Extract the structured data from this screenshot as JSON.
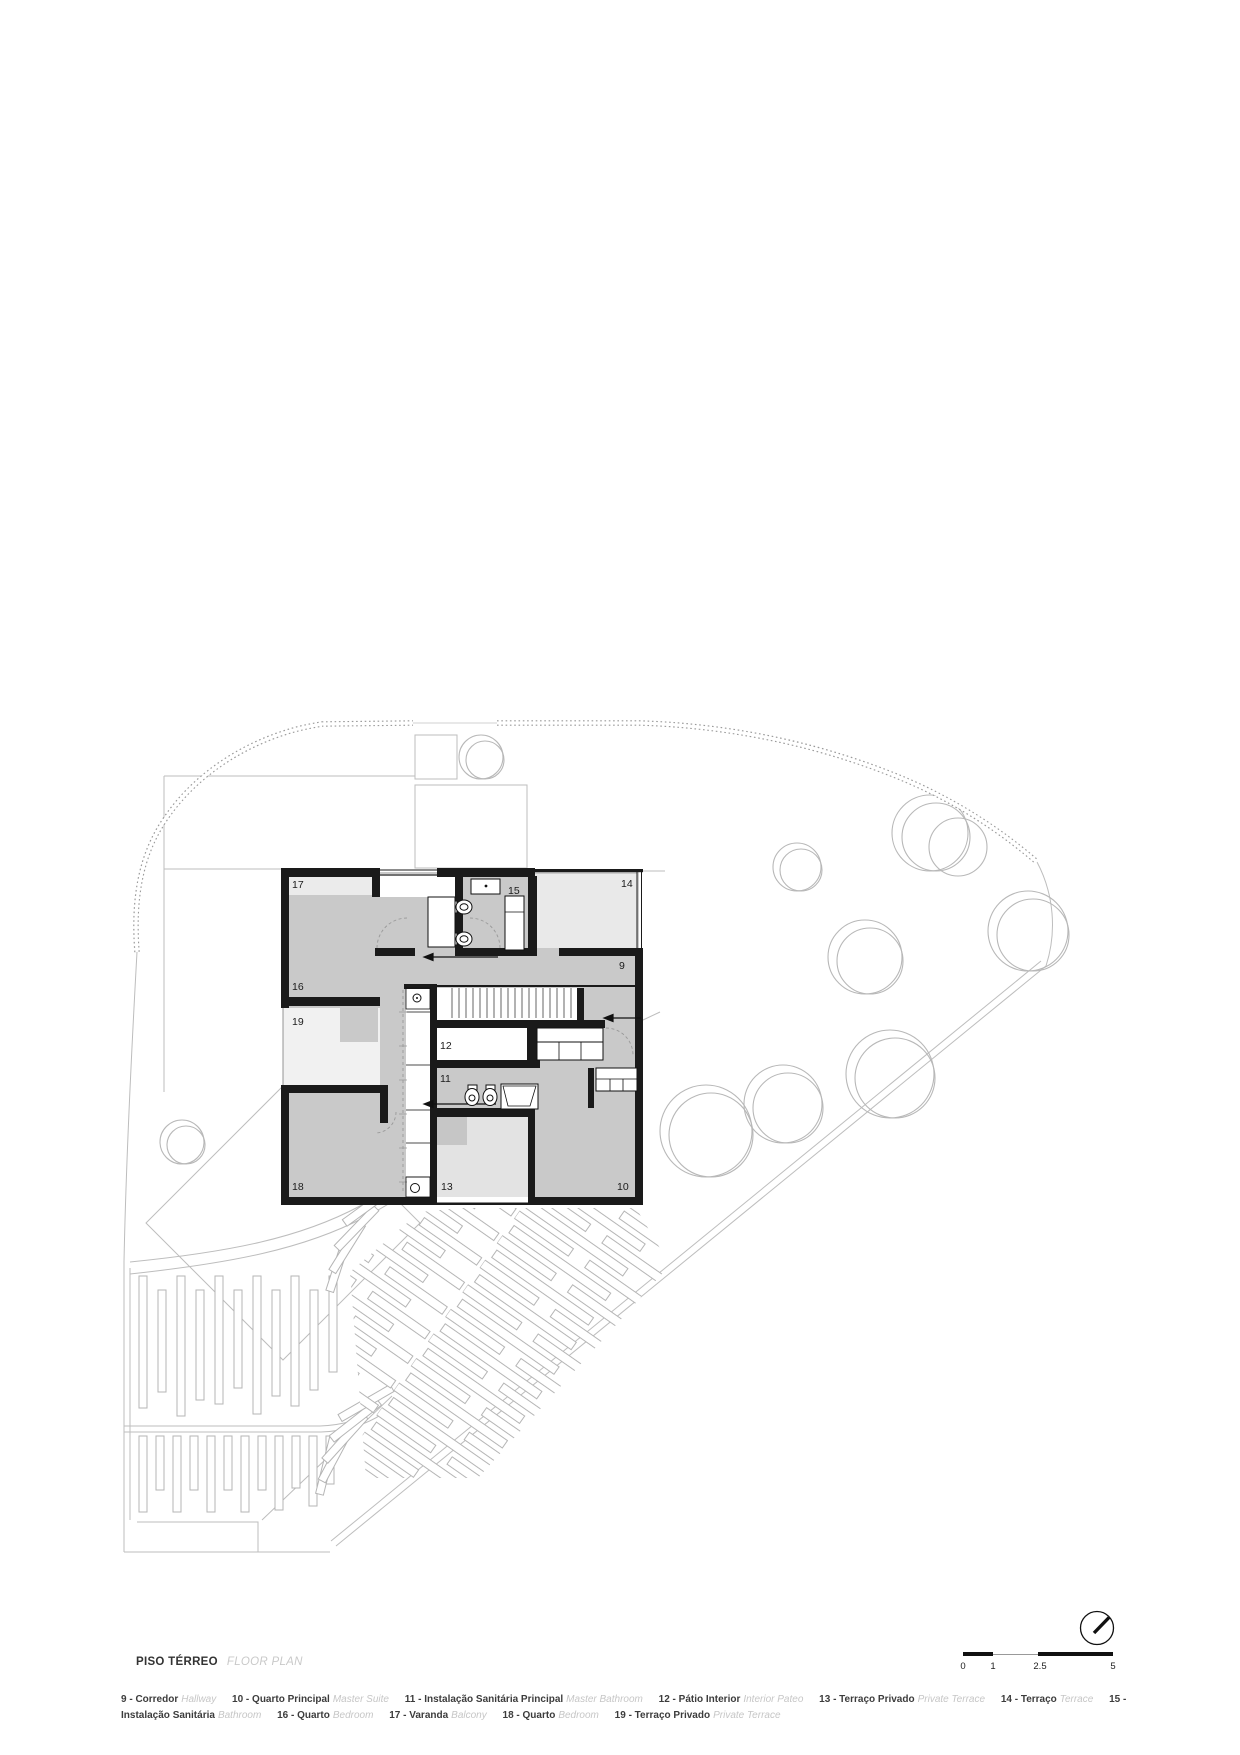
{
  "title": {
    "pt": "PISO TÉRREO",
    "en": "FLOOR PLAN"
  },
  "legend": {
    "items": [
      {
        "pt": "9 - Corredor",
        "en": "Hallway"
      },
      {
        "pt": "10 - Quarto Principal",
        "en": "Master Suite"
      },
      {
        "pt": "11 - Instalação Sanitária Principal",
        "en": "Master Bathroom"
      },
      {
        "pt": "12 - Pátio Interior",
        "en": "Interior Pateo"
      },
      {
        "pt": "13 - Terraço Privado",
        "en": "Private Terrace"
      },
      {
        "pt": "14 - Terraço",
        "en": "Terrace"
      },
      {
        "pt": "15 - Instalação Sanitária",
        "en": "Bathroom"
      },
      {
        "pt": "16 - Quarto",
        "en": "Bedroom"
      },
      {
        "pt": "17 - Varanda",
        "en": "Balcony"
      },
      {
        "pt": "18 - Quarto",
        "en": "Bedroom"
      },
      {
        "pt": "19 - Terraço Privado",
        "en": "Private Terrace"
      }
    ]
  },
  "scalebar": {
    "ticks": [
      "0",
      "1",
      "2.5",
      "5"
    ]
  },
  "plan": {
    "room_labels": {
      "r9": "9",
      "r10": "10",
      "r11": "11",
      "r12": "12",
      "r13": "13",
      "r14": "14",
      "r15": "15",
      "r16": "16",
      "r17": "17",
      "r18": "18",
      "r19": "19"
    }
  },
  "icons": {
    "north_arrow": "compass-north-arrow"
  },
  "colors": {
    "wall": "#1a1a1a",
    "floor_gray": "#c9c9c9",
    "terrace_light": "#e9e9e9",
    "site_line": "#b5b5b5"
  }
}
